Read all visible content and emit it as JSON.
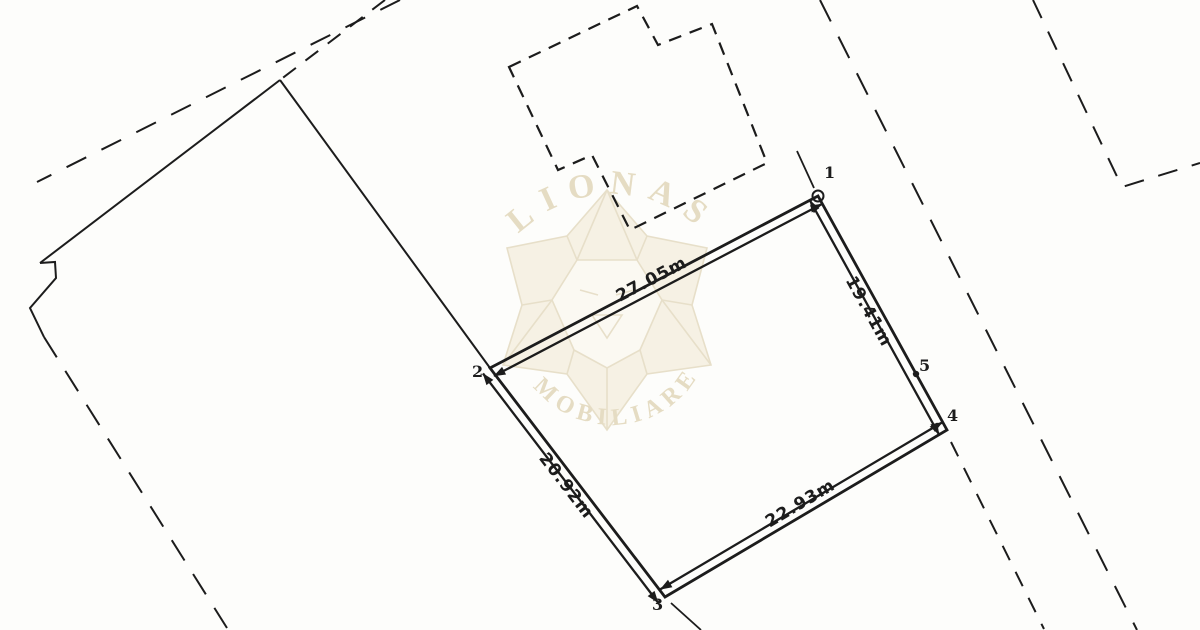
{
  "colors": {
    "background": "#fdfdfb",
    "ink": "#1c1c1c",
    "watermark_line": "#e7dfc9",
    "watermark_fill": "#f6f1e4",
    "watermark_face_fill": "#fbf9f2",
    "watermark_text": "#e5dcc3"
  },
  "watermark": {
    "arc_top": "LIONAS",
    "arc_bottom": "IMOBILIARE"
  },
  "plan": {
    "parcel": {
      "point_labels": [
        "1",
        "2",
        "3",
        "4",
        "5"
      ],
      "sides": [
        {
          "from": "1",
          "to": "2",
          "label": "27.05m",
          "length_m": 27.05
        },
        {
          "from": "1",
          "to": "4",
          "label": "19.41m",
          "length_m": 19.41
        },
        {
          "from": "2",
          "to": "3",
          "label": "20.92m",
          "length_m": 20.92
        },
        {
          "from": "3",
          "to": "4",
          "label": "22.93m",
          "length_m": 22.93
        }
      ]
    }
  }
}
